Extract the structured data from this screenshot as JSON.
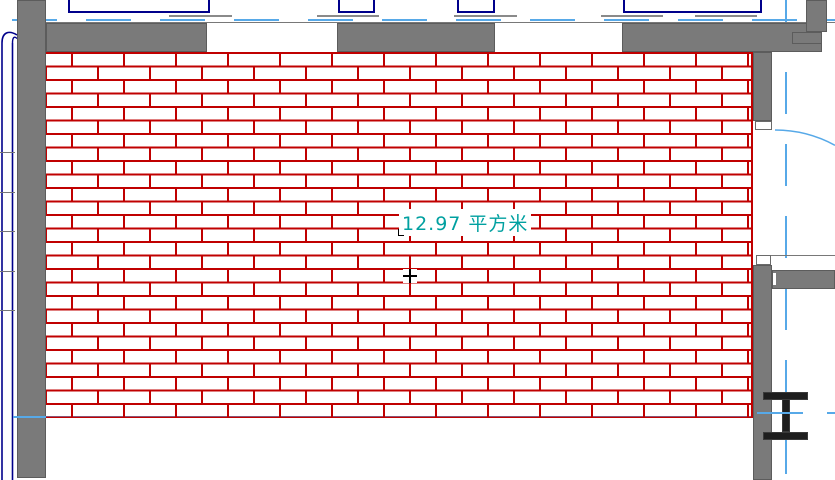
{
  "view": {
    "name": "cad-floor-plan-viewport"
  },
  "room": {
    "area_label": "12.97 平方米"
  },
  "colors": {
    "wall_fill": "#7a7a7a",
    "wall_outline": "#5c5c5c",
    "brick_hatch_red": "#c00000",
    "centerline_blue": "#57a9e8",
    "window_navy": "#00008b",
    "area_label_teal": "#00a0a0",
    "marker_black": "#000000"
  },
  "symbols": {
    "floor_hatch": "brick-running-bond",
    "steel_column": "i-beam-section",
    "door": "swing-arc",
    "pipe": "double-line-riser"
  }
}
